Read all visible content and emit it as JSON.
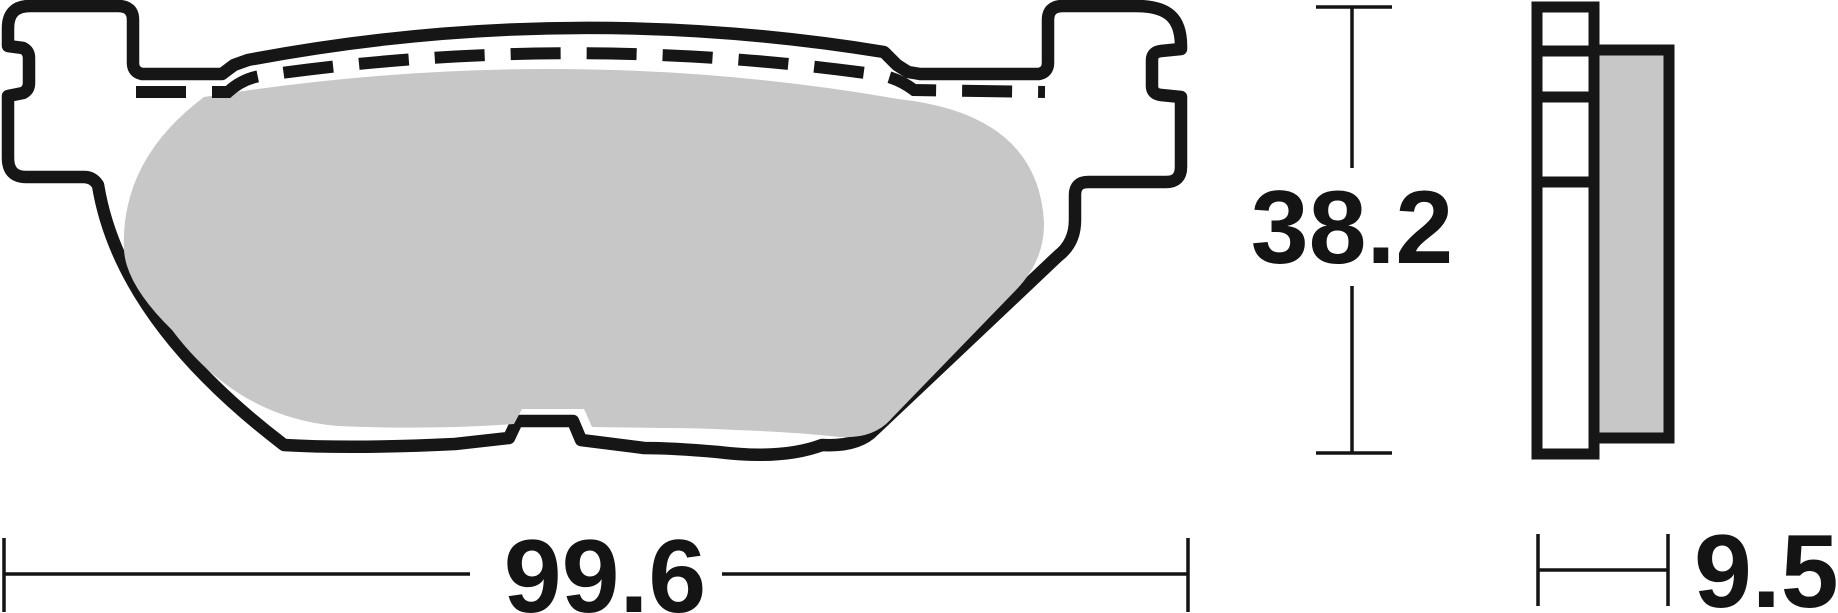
{
  "drawing": {
    "title": "brake-pad-technical-drawing",
    "dimensions": {
      "width": "99.6",
      "height": "38.2",
      "thickness": "9.5"
    },
    "colors": {
      "line": "#161616",
      "friction_material": "#c7c7c7",
      "background": "#ffffff"
    }
  }
}
